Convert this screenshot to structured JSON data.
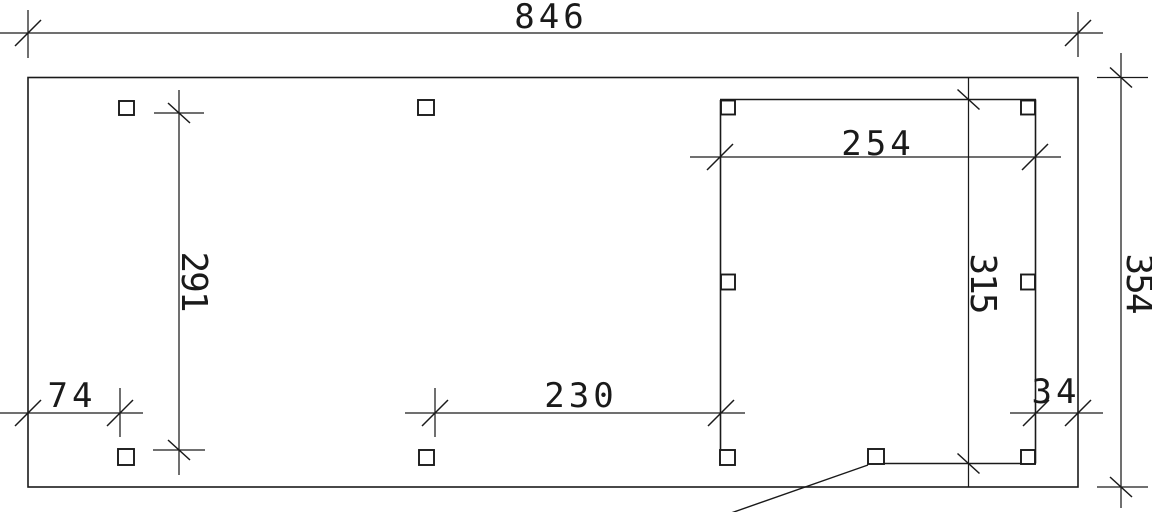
{
  "page": {
    "width": 1152,
    "height": 512,
    "background": "#ffffff",
    "ink_color": "#1a1a1a",
    "wall_stroke": 1.6,
    "dim_stroke": 1.25,
    "post_stroke": 1.9
  },
  "plan": {
    "outer_frame": {
      "x": 28,
      "y": 77.5,
      "w": 1050,
      "h": 409.5
    },
    "inner_walls": [
      {
        "name": "inner-bay-wall-left",
        "x1": 720.5,
        "y1": 100,
        "x2": 720.5,
        "y2": 450
      },
      {
        "name": "inner-bay-wall-top",
        "x1": 720,
        "y1": 99.5,
        "x2": 1036,
        "y2": 99.5
      },
      {
        "name": "inner-bay-wall-right",
        "x1": 1035.5,
        "y1": 99.5,
        "x2": 1035.5,
        "y2": 463.5
      },
      {
        "name": "inner-bay-wall-bottom",
        "x1": 884,
        "y1": 463.5,
        "x2": 1036,
        "y2": 463.5
      }
    ],
    "posts": [
      {
        "x": 119,
        "y": 101,
        "w": 15,
        "h": 14
      },
      {
        "x": 418,
        "y": 100,
        "w": 16,
        "h": 15
      },
      {
        "x": 118,
        "y": 449,
        "w": 16,
        "h": 16
      },
      {
        "x": 419,
        "y": 450,
        "w": 15,
        "h": 15
      },
      {
        "x": 721,
        "y": 100.5,
        "w": 14,
        "h": 14
      },
      {
        "x": 1021,
        "y": 100.5,
        "w": 14,
        "h": 14
      },
      {
        "x": 721,
        "y": 274.5,
        "w": 14,
        "h": 15
      },
      {
        "x": 1021,
        "y": 274.5,
        "w": 14,
        "h": 15
      },
      {
        "x": 720,
        "y": 450,
        "w": 15,
        "h": 15
      },
      {
        "x": 868,
        "y": 449,
        "w": 16,
        "h": 15
      },
      {
        "x": 1021,
        "y": 450,
        "w": 14,
        "h": 14
      }
    ],
    "leader_line": {
      "x1": 731,
      "y1": 513,
      "x2": 868,
      "y2": 465
    }
  },
  "dimensions": [
    {
      "label": "846",
      "dir": "h",
      "line": [
        0,
        33,
        1103,
        33
      ],
      "ticks": [
        [
          28,
          33
        ],
        [
          1078,
          33
        ]
      ],
      "exts": [
        [
          28,
          10,
          28,
          58
        ],
        [
          1078,
          12,
          1078,
          57
        ]
      ],
      "text": [
        551,
        28
      ]
    },
    {
      "label": "354",
      "dir": "v",
      "line": [
        1121,
        53,
        1121,
        508
      ],
      "ticks": [
        [
          1121,
          77.5
        ],
        [
          1121,
          487
        ]
      ],
      "exts": [
        [
          1097,
          77.5,
          1148,
          77.5
        ],
        [
          1097,
          487,
          1148,
          487
        ]
      ],
      "text": [
        1127,
        283
      ]
    },
    {
      "label": "291",
      "dir": "v",
      "line": [
        179,
        90,
        179,
        475
      ],
      "ticks": [
        [
          179,
          113
        ],
        [
          179,
          450
        ]
      ],
      "exts": [
        [
          154,
          113,
          204,
          113
        ],
        [
          153,
          450,
          205,
          450
        ]
      ],
      "text": [
        182,
        281
      ]
    },
    {
      "label": "315",
      "dir": "v",
      "line": [
        968.5,
        77,
        968.5,
        487
      ],
      "ticks": [
        [
          968.5,
          99.5
        ],
        [
          968.5,
          463.5
        ]
      ],
      "exts": [],
      "text": [
        971,
        283
      ]
    },
    {
      "label": "74",
      "dir": "h",
      "line": [
        0,
        413,
        143,
        413
      ],
      "ticks": [
        [
          28,
          413
        ],
        [
          120,
          413
        ]
      ],
      "exts": [
        [
          120,
          388,
          120,
          437
        ]
      ],
      "text": [
        72,
        407
      ]
    },
    {
      "label": "230",
      "dir": "h",
      "line": [
        405,
        413,
        745,
        413
      ],
      "ticks": [
        [
          435,
          413
        ],
        [
          721,
          413
        ]
      ],
      "exts": [
        [
          435,
          388,
          435,
          437
        ]
      ],
      "text": [
        581,
        407
      ]
    },
    {
      "label": "254",
      "dir": "h",
      "line": [
        690,
        157,
        1061,
        157
      ],
      "ticks": [
        [
          720,
          157
        ],
        [
          1035,
          157
        ]
      ],
      "exts": [],
      "text": [
        878,
        155
      ]
    },
    {
      "label": "34",
      "dir": "h",
      "line": [
        1010,
        413,
        1103,
        413
      ],
      "ticks": [
        [
          1036,
          413
        ],
        [
          1078,
          413
        ]
      ],
      "exts": [],
      "text": [
        1056,
        403
      ]
    }
  ]
}
